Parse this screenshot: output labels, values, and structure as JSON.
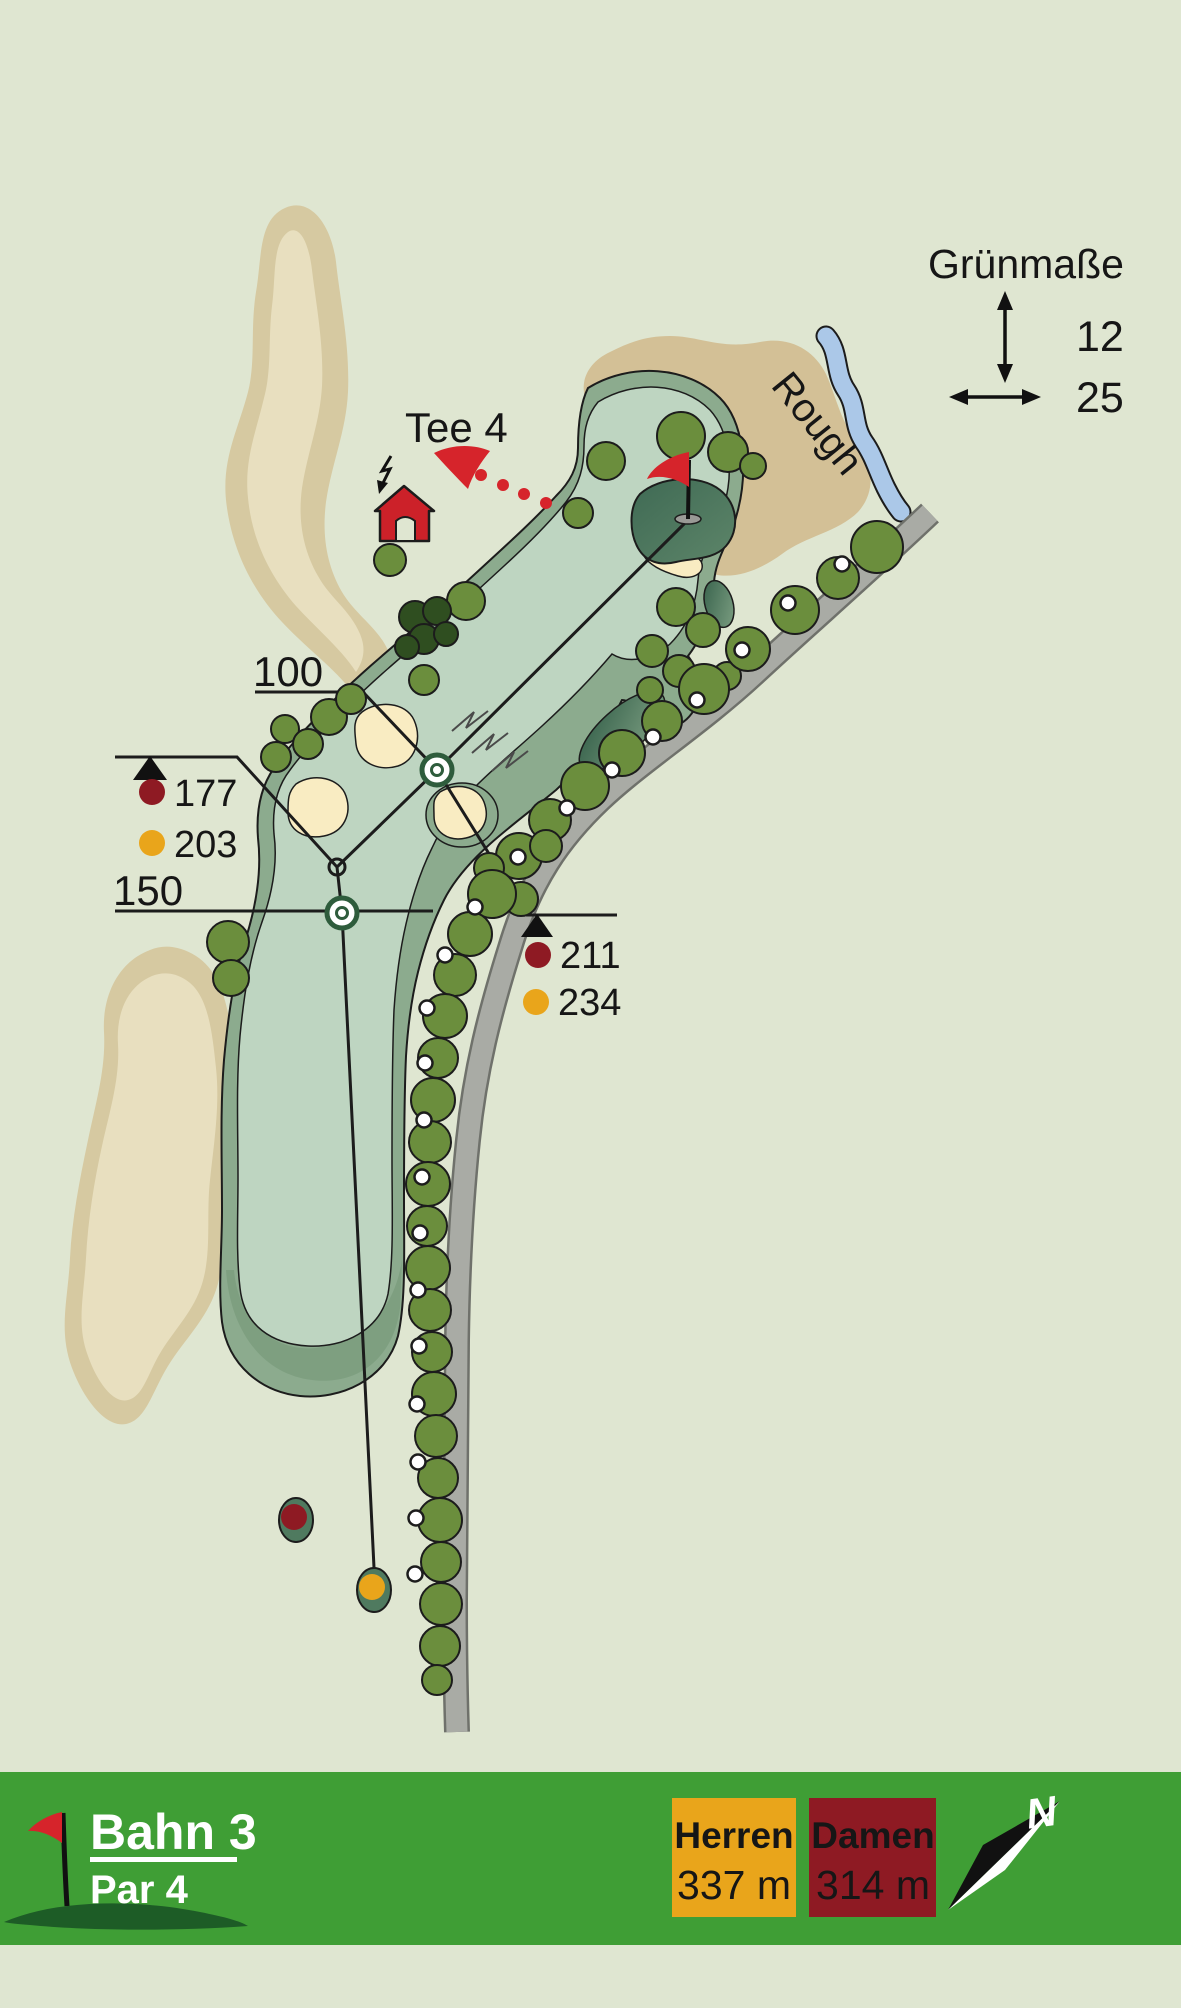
{
  "legend": {
    "title": "Grünmaße",
    "depth_value": "12",
    "width_value": "25"
  },
  "map": {
    "tee_label": "Tee 4",
    "rough_label": "Rough",
    "distance_100": "100",
    "distance_150": "150",
    "left_carry": {
      "damen": "177",
      "herren": "203"
    },
    "right_carry": {
      "damen": "211",
      "herren": "234"
    }
  },
  "footer": {
    "hole": "Bahn 3",
    "par": "Par 4",
    "herren_label": "Herren",
    "herren_distance": "337 m",
    "damen_label": "Damen",
    "damen_distance": "314 m",
    "north": "N"
  },
  "colors": {
    "background": "#dfe6d1",
    "bar_green": "#3f9e35",
    "herren_orange": "#e9a51b",
    "damen_red": "#8e1a23",
    "accent_red": "#d6242b",
    "fairway_light": "#bed5c1",
    "fairway_border": "#8cab8e",
    "putting_green": "#50795f",
    "sand": "#d6c9a1",
    "water": "#abc8e8",
    "path_gray": "#a9aba5",
    "tree_olive": "#6b8e3d"
  }
}
